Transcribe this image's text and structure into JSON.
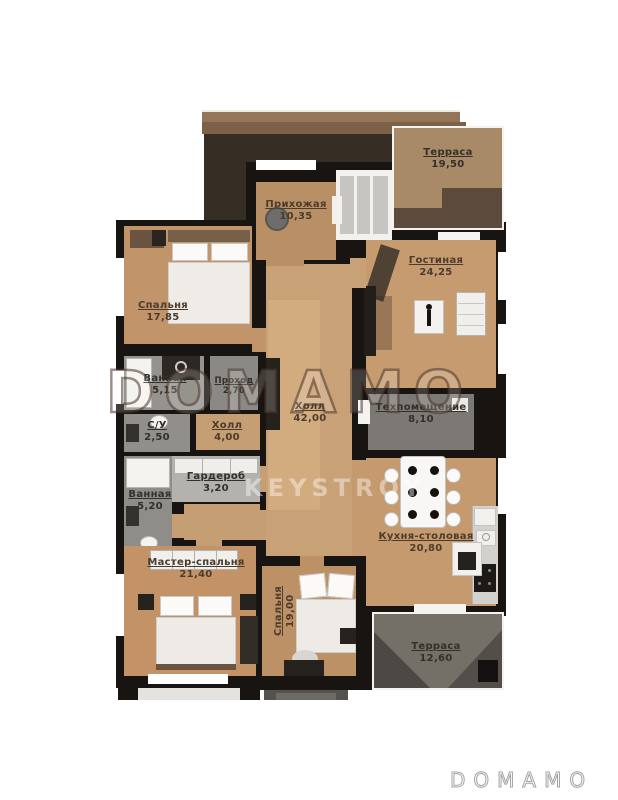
{
  "watermarks": {
    "center_logo": "DOMAMO",
    "builder_logo": "KEYSTROY",
    "footer_logo": "DOMAMO"
  },
  "rooms": [
    {
      "name": "Терраса",
      "area": "19,50"
    },
    {
      "name": "Прихожая",
      "area": "10,35"
    },
    {
      "name": "Гостиная",
      "area": "24,25"
    },
    {
      "name": "Спальня",
      "area": "17,85"
    },
    {
      "name": "Ванная",
      "area": "5,15"
    },
    {
      "name": "Проход",
      "area": "2,70"
    },
    {
      "name": "С/У",
      "area": "2,50"
    },
    {
      "name": "Холл",
      "area": "4,00"
    },
    {
      "name": "Холл",
      "area": "42,00"
    },
    {
      "name": "Техпомещение",
      "area": "8,10"
    },
    {
      "name": "Гардероб",
      "area": "3,20"
    },
    {
      "name": "Ванная",
      "area": "5,20"
    },
    {
      "name": "Мастер-спальня",
      "area": "21,40"
    },
    {
      "name": "Спальня",
      "area": "19,00"
    },
    {
      "name": "Кухня-столовая",
      "area": "20,80"
    },
    {
      "name": "Терраса",
      "area": "12,60"
    }
  ],
  "colors": {
    "wall": "#171411",
    "floor_tan": "#c69b70",
    "floor_entry": "#b98f65",
    "wet_gray": "#93918c",
    "terrace_gray": "#747068",
    "terrace_top_dark": "#5c4a3d",
    "roof_tan": "#947558"
  }
}
